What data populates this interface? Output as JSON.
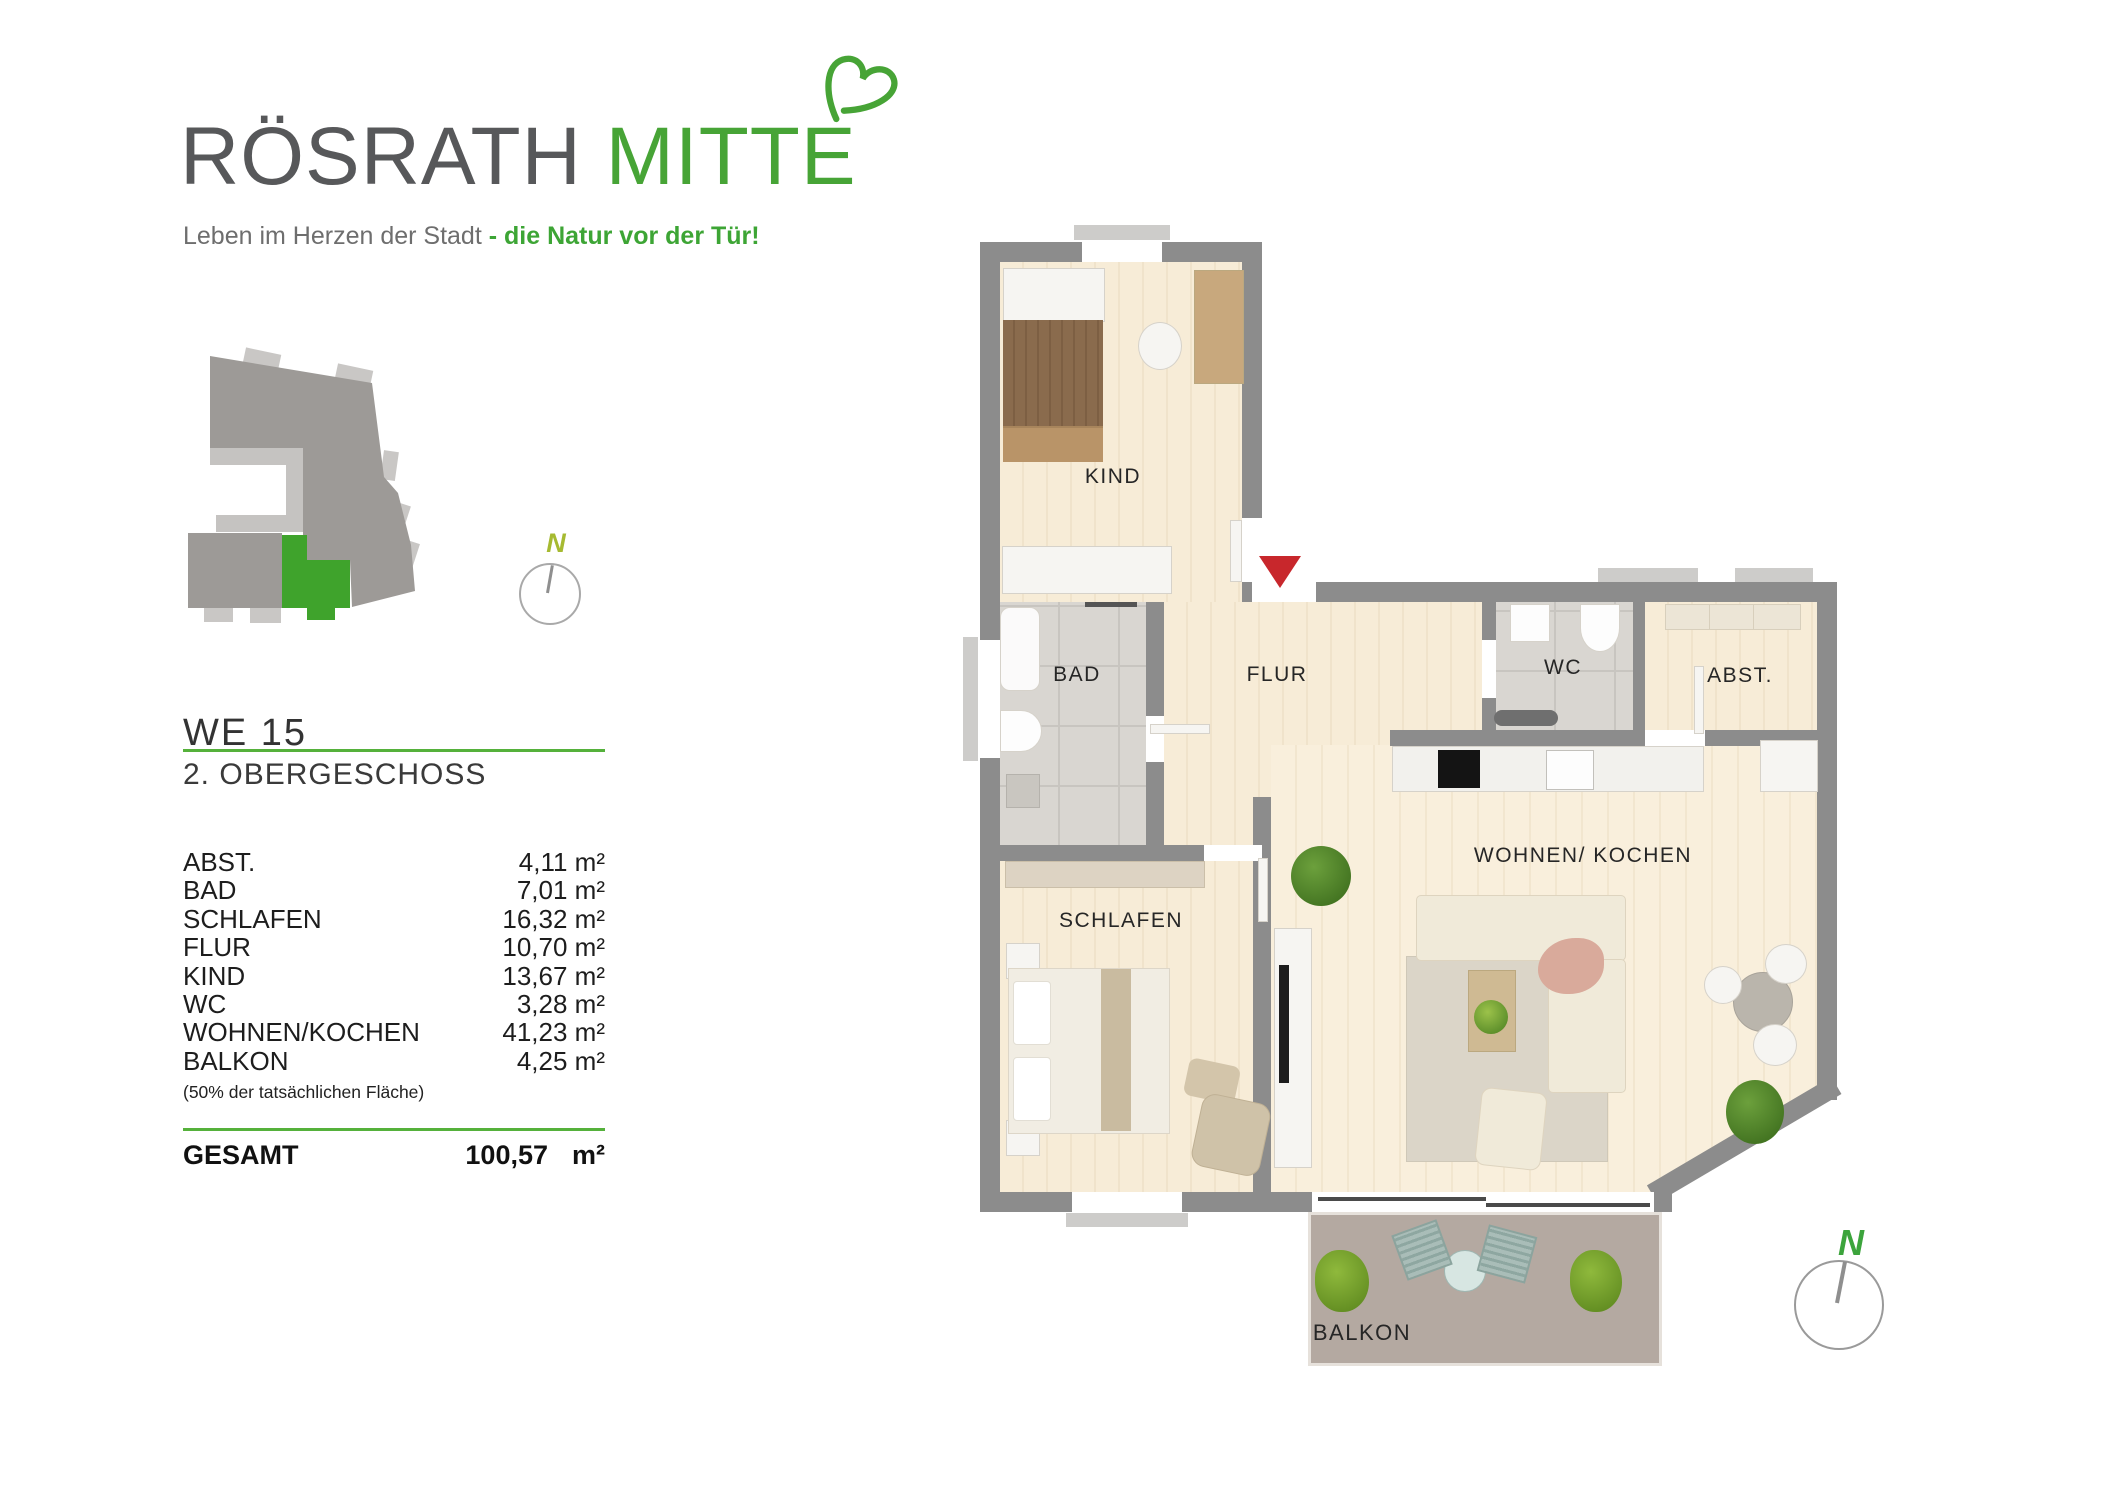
{
  "logo": {
    "title_gray": "RÖSRATH",
    "title_green": "MITTE",
    "tagline_gray": "Leben im Herzen der Stadt ",
    "tagline_green": "- die Natur vor der Tür!"
  },
  "unit": {
    "id": "WE 15",
    "floor": "2. OBERGESCHOSS"
  },
  "area_table": {
    "rows": [
      {
        "label": "ABST.",
        "value": "4,11 m²"
      },
      {
        "label": "BAD",
        "value": "7,01 m²"
      },
      {
        "label": "SCHLAFEN",
        "value": "16,32 m²"
      },
      {
        "label": "FLUR",
        "value": "10,70 m²"
      },
      {
        "label": "KIND",
        "value": "13,67 m²"
      },
      {
        "label": "WC",
        "value": "3,28 m²"
      },
      {
        "label": "WOHNEN/KOCHEN",
        "value": "41,23 m²"
      },
      {
        "label": "BALKON",
        "value": "4,25 m²"
      }
    ],
    "note": "(50% der tatsächlichen Fläche)",
    "total_label": "GESAMT",
    "total_value": "100,57",
    "total_unit": "m²"
  },
  "floorplan": {
    "labels": {
      "kind": "KIND",
      "bad": "BAD",
      "flur": "FLUR",
      "wc": "WC",
      "abst": "ABST.",
      "schlafen": "SCHLAFEN",
      "wohnen": "WOHNEN/ KOCHEN",
      "balkon": "BALKON"
    }
  },
  "compass": {
    "north_top": "N",
    "north_bottom": "N"
  },
  "colors": {
    "brand_green": "#47a436",
    "underline_green": "#55b13b",
    "site_plan_green": "#3fa32c",
    "entrance_red": "#c8272c",
    "wall_gray": "#8c8c8c"
  }
}
